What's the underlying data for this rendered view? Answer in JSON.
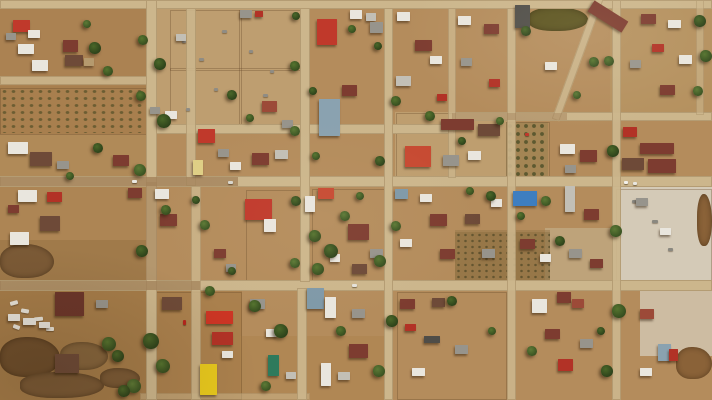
{
  "scene": {
    "name": "aerial-drone-view-flooded-town-grid",
    "width": 712,
    "height": 400
  },
  "palette": {
    "ground": "#b48c5c",
    "road": "#ccb68c",
    "road_wet": "#a3825a",
    "red": "#c0392b",
    "red2": "#b23226",
    "brightred": "#cc3524",
    "redorange": "#c74a32",
    "redbrown": "#9c4a38",
    "maroon": "#7d3c30",
    "dkmaroon": "#6b352a",
    "dkbrown": "#6e4a38",
    "white": "#e9e6de",
    "ltgray": "#c2bfb6",
    "gray": "#97948c",
    "dkgray": "#4f4d48",
    "bluegray": "#8aa2b0",
    "bluegray2": "#7f99a8",
    "blue": "#3e7ec0",
    "paleyellow": "#dfcf85",
    "yellow": "#e6c71d",
    "teal": "#2e7a5c",
    "tan": "#b59a6e",
    "pond": "#5b531f",
    "mud": "#7b5a36",
    "sediment": "#d7d0c1"
  },
  "zones": [
    [
      0,
      8,
      150,
      80,
      "#ab8252",
      1
    ],
    [
      0,
      86,
      150,
      48,
      "#a87f4e",
      1
    ],
    [
      150,
      8,
      152,
      122,
      "#bfa173",
      0.85
    ],
    [
      0,
      134,
      150,
      46,
      "#b08a58",
      1
    ],
    [
      0,
      187,
      150,
      97,
      "#ad8554",
      1
    ],
    [
      0,
      240,
      150,
      44,
      "#94703f",
      0.5
    ],
    [
      0,
      291,
      150,
      109,
      "#a57c49",
      1
    ],
    [
      612,
      185,
      100,
      100,
      "#d7d0c1",
      0.9
    ],
    [
      640,
      288,
      72,
      68,
      "#d7d0c1",
      0.7
    ],
    [
      545,
      228,
      68,
      56,
      "#cabf9f",
      0.45
    ],
    [
      455,
      230,
      95,
      56,
      "#97794a",
      0.55
    ],
    [
      395,
      112,
      115,
      68,
      "#c2a476",
      0.75
    ],
    [
      150,
      291,
      92,
      109,
      "#aa804d",
      1
    ],
    [
      610,
      8,
      102,
      104,
      "#b59560",
      0.6
    ],
    [
      240,
      336,
      150,
      64,
      "#ad834f",
      0.6
    ]
  ],
  "fields": [
    {
      "type": "orchard",
      "x": 0,
      "y": 88,
      "w": 147,
      "h": 45
    },
    {
      "type": "orchard2",
      "x": 506,
      "y": 122,
      "w": 42,
      "h": 56
    },
    {
      "type": "scrub",
      "x": 455,
      "y": 232,
      "w": 95,
      "h": 54
    }
  ],
  "water": [
    [
      0,
      244,
      54,
      34,
      "#7b5a36"
    ],
    [
      0,
      337,
      60,
      40,
      "#6e4e2c"
    ],
    [
      20,
      372,
      84,
      26,
      "#7b5a36"
    ],
    [
      60,
      342,
      48,
      28,
      "#86653d"
    ],
    [
      100,
      368,
      40,
      20,
      "#7b5a36"
    ],
    [
      676,
      347,
      36,
      32,
      "#8a6238"
    ],
    [
      697,
      194,
      15,
      52,
      "#8a6238"
    ],
    [
      528,
      7,
      60,
      24,
      "#5b531f"
    ]
  ],
  "fences": [
    [
      170,
      10,
      130,
      118
    ],
    [
      239,
      10,
      1,
      118
    ],
    [
      170,
      68,
      130,
      1
    ],
    [
      396,
      113,
      112,
      66
    ],
    [
      0,
      88,
      147,
      45
    ],
    [
      506,
      122,
      42,
      56
    ],
    [
      616,
      189,
      94,
      98
    ],
    [
      312,
      189,
      74,
      94
    ],
    [
      246,
      190,
      56,
      92
    ],
    [
      150,
      292,
      90,
      106
    ],
    [
      397,
      292,
      108,
      106
    ]
  ],
  "roads": [
    [
      0,
      0,
      712,
      9,
      1,
      0,
      0
    ],
    [
      0,
      76,
      152,
      9,
      0.9,
      0,
      0
    ],
    [
      152,
      124,
      302,
      10,
      1,
      0,
      0
    ],
    [
      452,
      112,
      260,
      9,
      1,
      0,
      0
    ],
    [
      0,
      176,
      712,
      11,
      1,
      0,
      0
    ],
    [
      0,
      280,
      712,
      11,
      1,
      0,
      0
    ],
    [
      140,
      393,
      170,
      7,
      0.55,
      0,
      0
    ],
    [
      146,
      0,
      11,
      400,
      1,
      0,
      0
    ],
    [
      186,
      8,
      10,
      178,
      0.9,
      0,
      0
    ],
    [
      191,
      186,
      10,
      214,
      0.85,
      0,
      0
    ],
    [
      300,
      8,
      10,
      274,
      1,
      0,
      0
    ],
    [
      297,
      288,
      10,
      112,
      0.95,
      0,
      0
    ],
    [
      384,
      8,
      9,
      392,
      1,
      0,
      0
    ],
    [
      448,
      8,
      8,
      170,
      0.8,
      0,
      0
    ],
    [
      507,
      8,
      9,
      392,
      0.9,
      0,
      0
    ],
    [
      612,
      0,
      9,
      400,
      0.95,
      0,
      0
    ],
    [
      696,
      0,
      8,
      115,
      0.6,
      0,
      0
    ],
    [
      574,
      -8,
      8,
      132,
      0.9,
      0,
      20
    ],
    [
      0,
      177,
      238,
      9,
      0.8,
      1,
      0
    ],
    [
      0,
      281,
      200,
      9,
      0.75,
      1,
      0
    ],
    [
      146,
      182,
      11,
      98,
      0.6,
      1,
      0
    ],
    [
      452,
      113,
      115,
      7,
      0.5,
      1,
      0
    ]
  ],
  "buildings": [
    [
      13,
      20,
      17,
      12,
      "red"
    ],
    [
      28,
      30,
      12,
      8,
      "white"
    ],
    [
      6,
      33,
      10,
      7,
      "gray"
    ],
    [
      63,
      40,
      15,
      12,
      "maroon"
    ],
    [
      18,
      44,
      16,
      10,
      "white"
    ],
    [
      65,
      55,
      18,
      11,
      "dkbrown"
    ],
    [
      32,
      60,
      16,
      11,
      "white"
    ],
    [
      84,
      58,
      10,
      8,
      "tan"
    ],
    [
      240,
      10,
      12,
      8,
      "gray"
    ],
    [
      255,
      11,
      8,
      6,
      "red2"
    ],
    [
      176,
      34,
      10,
      7,
      "ltgray"
    ],
    [
      317,
      19,
      20,
      26,
      "red"
    ],
    [
      350,
      10,
      12,
      9,
      "white"
    ],
    [
      366,
      13,
      10,
      8,
      "ltgray"
    ],
    [
      370,
      22,
      13,
      11,
      "gray"
    ],
    [
      342,
      85,
      15,
      11,
      "maroon"
    ],
    [
      319,
      99,
      21,
      37,
      "bluegray"
    ],
    [
      262,
      101,
      15,
      11,
      "redbrown"
    ],
    [
      282,
      120,
      11,
      8,
      "gray"
    ],
    [
      397,
      12,
      13,
      9,
      "white"
    ],
    [
      415,
      40,
      17,
      11,
      "maroon"
    ],
    [
      430,
      56,
      12,
      8,
      "white"
    ],
    [
      396,
      76,
      15,
      10,
      "ltgray"
    ],
    [
      437,
      94,
      10,
      7,
      "red2"
    ],
    [
      458,
      16,
      13,
      9,
      "white"
    ],
    [
      484,
      24,
      15,
      10,
      "maroon"
    ],
    [
      461,
      58,
      11,
      8,
      "gray"
    ],
    [
      489,
      79,
      11,
      8,
      "red2"
    ],
    [
      515,
      5,
      15,
      23,
      "dkgray"
    ],
    [
      588,
      10,
      40,
      13,
      "maroon",
      32
    ],
    [
      545,
      62,
      12,
      8,
      "white"
    ],
    [
      641,
      14,
      15,
      10,
      "maroon"
    ],
    [
      668,
      20,
      13,
      8,
      "white"
    ],
    [
      652,
      44,
      12,
      8,
      "red2"
    ],
    [
      630,
      60,
      11,
      8,
      "gray"
    ],
    [
      679,
      55,
      13,
      9,
      "white"
    ],
    [
      660,
      85,
      15,
      10,
      "maroon"
    ],
    [
      8,
      142,
      20,
      12,
      "white"
    ],
    [
      30,
      152,
      22,
      14,
      "dkbrown"
    ],
    [
      113,
      155,
      16,
      11,
      "maroon"
    ],
    [
      57,
      161,
      12,
      8,
      "gray"
    ],
    [
      150,
      107,
      10,
      7,
      "gray"
    ],
    [
      165,
      111,
      12,
      8,
      "white"
    ],
    [
      198,
      129,
      17,
      14,
      "red"
    ],
    [
      218,
      149,
      11,
      8,
      "gray"
    ],
    [
      252,
      153,
      17,
      12,
      "maroon"
    ],
    [
      230,
      162,
      11,
      8,
      "white"
    ],
    [
      275,
      150,
      13,
      9,
      "ltgray"
    ],
    [
      193,
      160,
      10,
      15,
      "paleyellow"
    ],
    [
      405,
      146,
      26,
      21,
      "redorange"
    ],
    [
      441,
      119,
      33,
      11,
      "maroon"
    ],
    [
      478,
      124,
      22,
      12,
      "dkbrown"
    ],
    [
      443,
      155,
      16,
      11,
      "gray"
    ],
    [
      468,
      151,
      13,
      9,
      "white"
    ],
    [
      560,
      144,
      15,
      10,
      "white"
    ],
    [
      580,
      150,
      17,
      12,
      "maroon"
    ],
    [
      565,
      165,
      11,
      8,
      "gray"
    ],
    [
      623,
      127,
      14,
      10,
      "red2"
    ],
    [
      640,
      143,
      34,
      11,
      "maroon"
    ],
    [
      622,
      158,
      22,
      12,
      "dkbrown"
    ],
    [
      648,
      159,
      28,
      14,
      "maroon"
    ],
    [
      18,
      190,
      19,
      12,
      "white"
    ],
    [
      47,
      192,
      15,
      10,
      "red2"
    ],
    [
      8,
      205,
      11,
      8,
      "maroon"
    ],
    [
      40,
      216,
      20,
      15,
      "dkbrown"
    ],
    [
      10,
      232,
      19,
      13,
      "white"
    ],
    [
      128,
      188,
      14,
      10,
      "maroon"
    ],
    [
      155,
      189,
      14,
      10,
      "white"
    ],
    [
      160,
      214,
      17,
      12,
      "maroon"
    ],
    [
      245,
      199,
      27,
      21,
      "red"
    ],
    [
      264,
      219,
      12,
      13,
      "white"
    ],
    [
      214,
      249,
      12,
      9,
      "maroon"
    ],
    [
      226,
      264,
      10,
      8,
      "gray"
    ],
    [
      318,
      188,
      16,
      11,
      "redorange"
    ],
    [
      305,
      196,
      10,
      16,
      "white"
    ],
    [
      348,
      224,
      21,
      16,
      "maroon"
    ],
    [
      330,
      254,
      10,
      8,
      "white"
    ],
    [
      370,
      249,
      13,
      9,
      "gray"
    ],
    [
      352,
      264,
      15,
      10,
      "dkbrown"
    ],
    [
      395,
      189,
      13,
      10,
      "bluegray2"
    ],
    [
      420,
      194,
      12,
      8,
      "white"
    ],
    [
      430,
      214,
      17,
      12,
      "maroon"
    ],
    [
      400,
      239,
      12,
      8,
      "white"
    ],
    [
      440,
      249,
      15,
      10,
      "maroon"
    ],
    [
      465,
      214,
      15,
      10,
      "dkbrown"
    ],
    [
      482,
      249,
      13,
      9,
      "gray"
    ],
    [
      491,
      199,
      11,
      8,
      "white"
    ],
    [
      513,
      191,
      24,
      15,
      "blue"
    ],
    [
      520,
      239,
      15,
      10,
      "maroon"
    ],
    [
      540,
      254,
      11,
      8,
      "white"
    ],
    [
      565,
      186,
      10,
      26,
      "ltgray"
    ],
    [
      584,
      209,
      15,
      11,
      "maroon"
    ],
    [
      569,
      249,
      13,
      9,
      "gray"
    ],
    [
      590,
      259,
      13,
      9,
      "maroon"
    ],
    [
      636,
      198,
      12,
      8,
      "gray"
    ],
    [
      660,
      228,
      11,
      7,
      "white"
    ],
    [
      55,
      292,
      29,
      24,
      "dkmaroon"
    ],
    [
      8,
      314,
      12,
      7,
      "white"
    ],
    [
      23,
      318,
      13,
      7,
      "white"
    ],
    [
      39,
      322,
      11,
      6,
      "white"
    ],
    [
      55,
      354,
      24,
      19,
      "dkbrown"
    ],
    [
      96,
      300,
      12,
      8,
      "gray"
    ],
    [
      162,
      297,
      20,
      13,
      "dkbrown"
    ],
    [
      206,
      311,
      27,
      13,
      "brightred"
    ],
    [
      212,
      332,
      21,
      13,
      "red2"
    ],
    [
      222,
      351,
      11,
      7,
      "white"
    ],
    [
      200,
      364,
      17,
      31,
      "yellow"
    ],
    [
      250,
      299,
      15,
      10,
      "gray"
    ],
    [
      266,
      329,
      11,
      8,
      "white"
    ],
    [
      268,
      355,
      11,
      21,
      "teal"
    ],
    [
      286,
      372,
      10,
      7,
      "ltgray"
    ],
    [
      307,
      288,
      17,
      21,
      "bluegray2"
    ],
    [
      325,
      297,
      11,
      21,
      "white"
    ],
    [
      352,
      309,
      13,
      9,
      "gray"
    ],
    [
      349,
      344,
      19,
      14,
      "maroon"
    ],
    [
      321,
      363,
      10,
      23,
      "white"
    ],
    [
      338,
      372,
      12,
      8,
      "ltgray"
    ],
    [
      400,
      299,
      15,
      10,
      "maroon"
    ],
    [
      432,
      298,
      13,
      9,
      "dkbrown"
    ],
    [
      405,
      324,
      11,
      7,
      "red2"
    ],
    [
      424,
      336,
      16,
      7,
      "dkgray"
    ],
    [
      412,
      368,
      13,
      8,
      "white"
    ],
    [
      455,
      345,
      13,
      9,
      "gray"
    ],
    [
      532,
      299,
      15,
      14,
      "white"
    ],
    [
      557,
      292,
      14,
      11,
      "maroon"
    ],
    [
      572,
      299,
      12,
      9,
      "redbrown"
    ],
    [
      545,
      329,
      15,
      10,
      "maroon"
    ],
    [
      580,
      339,
      13,
      9,
      "gray"
    ],
    [
      558,
      359,
      15,
      12,
      "red2"
    ],
    [
      640,
      309,
      14,
      10,
      "redbrown"
    ],
    [
      658,
      344,
      13,
      17,
      "bluegray"
    ],
    [
      669,
      349,
      9,
      12,
      "red2"
    ],
    [
      640,
      368,
      12,
      8,
      "white"
    ]
  ],
  "trees": [
    [
      143,
      40,
      5,
      1
    ],
    [
      160,
      64,
      6,
      2
    ],
    [
      141,
      96,
      5,
      1
    ],
    [
      164,
      121,
      7,
      2
    ],
    [
      140,
      170,
      6,
      3
    ],
    [
      166,
      210,
      5,
      1
    ],
    [
      142,
      251,
      6,
      2
    ],
    [
      151,
      341,
      8,
      2
    ],
    [
      163,
      366,
      7,
      1
    ],
    [
      134,
      386,
      7,
      3
    ],
    [
      118,
      356,
      6,
      2
    ],
    [
      109,
      344,
      7,
      1
    ],
    [
      124,
      391,
      6,
      2
    ],
    [
      95,
      48,
      6,
      2
    ],
    [
      108,
      71,
      5,
      1
    ],
    [
      87,
      24,
      4,
      3
    ],
    [
      98,
      148,
      5,
      2
    ],
    [
      70,
      176,
      4,
      1
    ],
    [
      295,
      66,
      5,
      1
    ],
    [
      313,
      91,
      4,
      2
    ],
    [
      295,
      131,
      5,
      3
    ],
    [
      316,
      156,
      4,
      1
    ],
    [
      296,
      201,
      5,
      2
    ],
    [
      315,
      236,
      6,
      1
    ],
    [
      295,
      263,
      5,
      3
    ],
    [
      331,
      251,
      7,
      2
    ],
    [
      318,
      269,
      6,
      1
    ],
    [
      345,
      216,
      5,
      3
    ],
    [
      360,
      196,
      4,
      1
    ],
    [
      378,
      46,
      4,
      2
    ],
    [
      396,
      101,
      5,
      1
    ],
    [
      380,
      161,
      5,
      2
    ],
    [
      396,
      226,
      5,
      3
    ],
    [
      380,
      261,
      6,
      1
    ],
    [
      392,
      321,
      6,
      2
    ],
    [
      379,
      371,
      6,
      3
    ],
    [
      470,
      191,
      4,
      1
    ],
    [
      491,
      196,
      5,
      2
    ],
    [
      521,
      216,
      4,
      1
    ],
    [
      546,
      201,
      5,
      3
    ],
    [
      560,
      241,
      5,
      2
    ],
    [
      609,
      61,
      5,
      1
    ],
    [
      613,
      151,
      6,
      2
    ],
    [
      616,
      231,
      6,
      3
    ],
    [
      619,
      311,
      7,
      1
    ],
    [
      607,
      371,
      6,
      2
    ],
    [
      700,
      21,
      6,
      2
    ],
    [
      706,
      56,
      6,
      1
    ],
    [
      698,
      91,
      5,
      3
    ],
    [
      352,
      29,
      4,
      1
    ],
    [
      296,
      16,
      4,
      2
    ],
    [
      255,
      306,
      6,
      1
    ],
    [
      281,
      331,
      7,
      2
    ],
    [
      266,
      386,
      5,
      3
    ],
    [
      341,
      331,
      5,
      1
    ],
    [
      452,
      301,
      5,
      2
    ],
    [
      492,
      331,
      4,
      1
    ],
    [
      532,
      351,
      5,
      3
    ],
    [
      601,
      331,
      4,
      2
    ],
    [
      430,
      116,
      5,
      1
    ],
    [
      462,
      141,
      4,
      2
    ],
    [
      500,
      121,
      4,
      3
    ],
    [
      526,
      31,
      5,
      2
    ],
    [
      594,
      62,
      5,
      1
    ],
    [
      577,
      95,
      4,
      3
    ],
    [
      210,
      291,
      5,
      1
    ],
    [
      232,
      271,
      4,
      2
    ],
    [
      205,
      225,
      5,
      3
    ],
    [
      196,
      200,
      4,
      2
    ],
    [
      232,
      95,
      5,
      2
    ],
    [
      250,
      118,
      4,
      1
    ]
  ],
  "debris": [
    [
      10,
      301,
      8,
      4,
      "#e8e4da",
      -15
    ],
    [
      21,
      309,
      8,
      4,
      "#e8e4da",
      10
    ],
    [
      34,
      317,
      9,
      4,
      "#e8e4da",
      -5
    ],
    [
      13,
      325,
      7,
      4,
      "#e8e4da",
      20
    ],
    [
      46,
      327,
      8,
      4,
      "#e8e4da",
      0
    ],
    [
      182,
      40,
      4,
      3,
      "#8f8c84",
      0
    ],
    [
      199,
      58,
      5,
      3,
      "#8f8c84",
      0
    ],
    [
      214,
      88,
      4,
      3,
      "#8f8c84",
      0
    ],
    [
      249,
      50,
      4,
      3,
      "#8f8c84",
      0
    ],
    [
      263,
      94,
      5,
      3,
      "#8f8c84",
      0
    ],
    [
      186,
      108,
      4,
      3,
      "#8f8c84",
      0
    ],
    [
      222,
      30,
      5,
      3,
      "#8f8c84",
      0
    ],
    [
      270,
      70,
      4,
      3,
      "#8f8c84",
      0
    ],
    [
      632,
      200,
      5,
      3,
      "#8a8880",
      0
    ],
    [
      652,
      220,
      6,
      3,
      "#8a8880",
      0
    ],
    [
      668,
      248,
      5,
      3,
      "#8a8880",
      0
    ]
  ],
  "vehicles": [
    [
      132,
      180,
      5,
      3,
      "#eae8e2"
    ],
    [
      228,
      181,
      5,
      3,
      "#d8d5cd"
    ],
    [
      624,
      181,
      4,
      3,
      "#f2f0ea"
    ],
    [
      633,
      182,
      4,
      3,
      "#e8e6e0"
    ],
    [
      183,
      320,
      3,
      5,
      "#b5251c"
    ],
    [
      352,
      284,
      5,
      3,
      "#e5e2da"
    ],
    [
      525,
      133,
      4,
      3,
      "#c0372b"
    ]
  ]
}
